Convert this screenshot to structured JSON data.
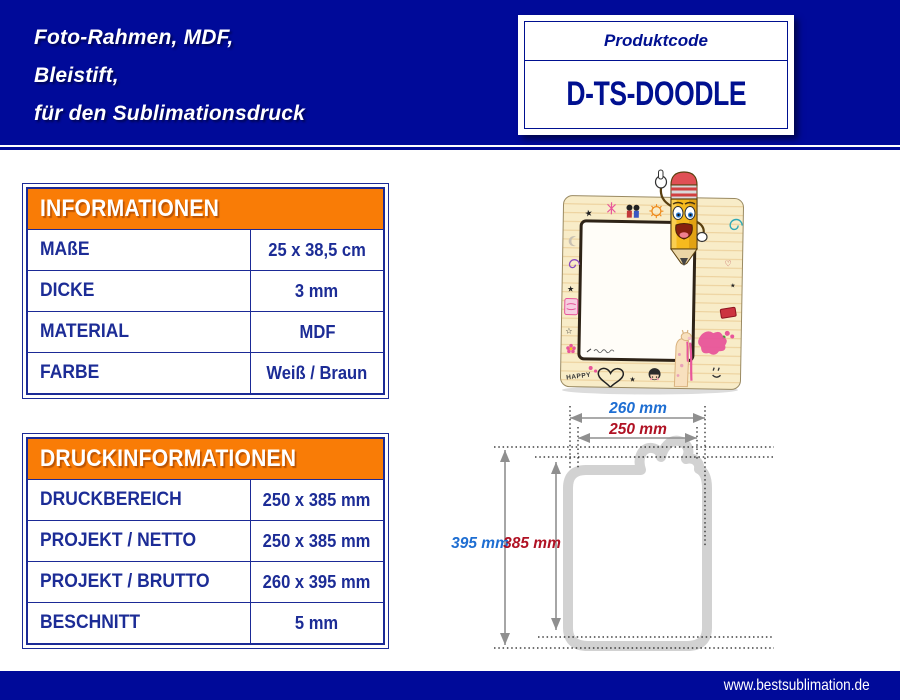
{
  "header": {
    "title_lines": [
      "Foto-Rahmen, MDF,",
      "Bleistift,",
      "für den Sublimationsdruck"
    ]
  },
  "product_code_box": {
    "label": "Produktcode",
    "code": "D-TS-DOODLE"
  },
  "info_table": {
    "title": "INFORMATIONEN",
    "rows": [
      {
        "label": "MAßE",
        "value": "25 x 38,5 cm"
      },
      {
        "label": "DICKE",
        "value": "3 mm"
      },
      {
        "label": "MATERIAL",
        "value": "MDF"
      },
      {
        "label": "FARBE",
        "value": "Weiß / Braun"
      }
    ]
  },
  "print_table": {
    "title": "DRUCKINFORMATIONEN",
    "rows": [
      {
        "label": "DRUCKBEREICH",
        "value": "250 x 385 mm"
      },
      {
        "label": "PROJEKT / NETTO",
        "value": "250 x 385 mm"
      },
      {
        "label": "PROJEKT / BRUTTO",
        "value": "260 x 395 mm"
      },
      {
        "label": "BESCHNITT",
        "value": "5 mm"
      }
    ]
  },
  "product_image": {
    "doodle_text": "HAPPY"
  },
  "dimension_diagram": {
    "width_outer": "260 mm",
    "width_inner": "250 mm",
    "height_outer": "395 mm",
    "height_inner": "385 mm"
  },
  "footer": {
    "website": "www.bestsublimation.de"
  },
  "colors": {
    "navy": "#000A99",
    "orange": "#F97C06",
    "table_text": "#1C2C96",
    "dim_blue": "#1E6ED2",
    "dim_red": "#B01224",
    "arrow_gray": "#8F8F8F",
    "outline_gray": "#D2D2D2"
  }
}
